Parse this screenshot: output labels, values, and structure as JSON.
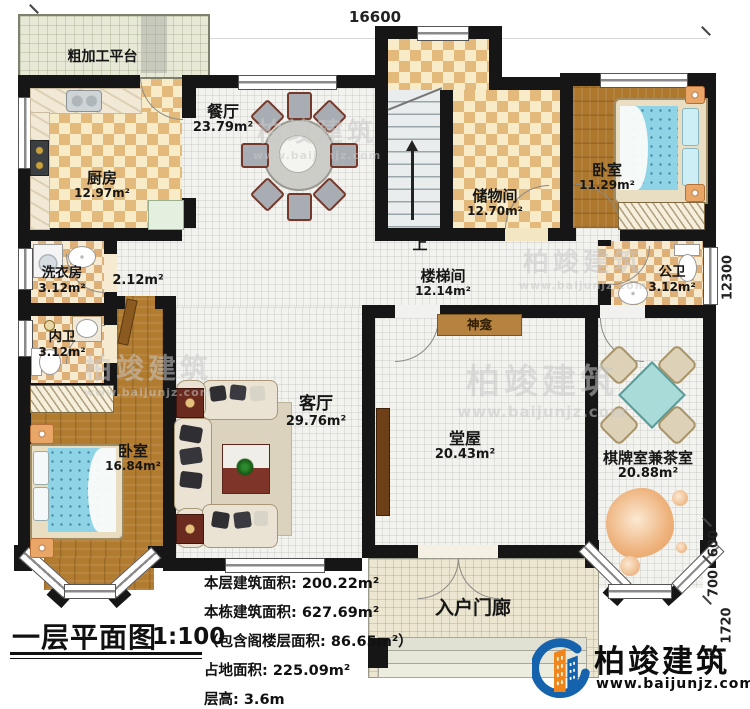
{
  "plan_title": {
    "title": "一层平面图",
    "scale": "1:100",
    "stats": [
      "本层建筑面积: 200.22m²",
      "本栋建筑面积: 627.69m²",
      "（包含阁楼层面积: 86.65m²）",
      "占地面积: 225.09m²",
      "层高: 3.6m"
    ]
  },
  "dimensions": {
    "top": "16600",
    "right_main": "12300",
    "right_600": "600",
    "right_700": "700",
    "right_1720": "1720"
  },
  "rooms": {
    "platform": {
      "label": "粗加工平台"
    },
    "kitchen": {
      "label": "厨房",
      "area": "12.97m²"
    },
    "dining": {
      "label": "餐厅",
      "area": "23.79m²"
    },
    "hallway": {
      "area": "2.12m²"
    },
    "laundry": {
      "label": "洗衣房",
      "area": "3.12m²"
    },
    "inner_bath": {
      "label": "内卫",
      "area": "3.12m²"
    },
    "bedroom_sw": {
      "label": "卧室",
      "area": "16.84m²"
    },
    "living": {
      "label": "客厅",
      "area": "29.76m²"
    },
    "stairwell": {
      "label": "楼梯间",
      "area": "12.14m²",
      "up": "上"
    },
    "storage": {
      "label": "储物间",
      "area": "12.70m²"
    },
    "bedroom_ne": {
      "label": "卧室",
      "area": "11.29m²"
    },
    "public_bath": {
      "label": "公卫",
      "area": "3.12m²"
    },
    "shrine": {
      "label": "神龛"
    },
    "hall": {
      "label": "堂屋",
      "area": "20.43m²"
    },
    "chess_tea": {
      "label": "棋牌室兼茶室",
      "area": "20.88m²"
    },
    "porch": {
      "label": "入户门廊"
    }
  },
  "brand": {
    "name": "柏竣建筑",
    "url": "www.baijunjz.com"
  },
  "watermark": {
    "name": "柏竣建筑",
    "url": "www.baijunjz.com"
  },
  "colors": {
    "wall": "#161616",
    "checker_dark": "#e4ba7c",
    "checker_light": "#f8ecc8",
    "wood": "#b27c30",
    "bed_blue": "#8fd4e6",
    "platform_green": "#e7e8d6",
    "porch_beige": "#ece5cf",
    "logo_blue": "#1663ad",
    "logo_orange": "#f08519",
    "shrine_brown": "#b5823f"
  }
}
